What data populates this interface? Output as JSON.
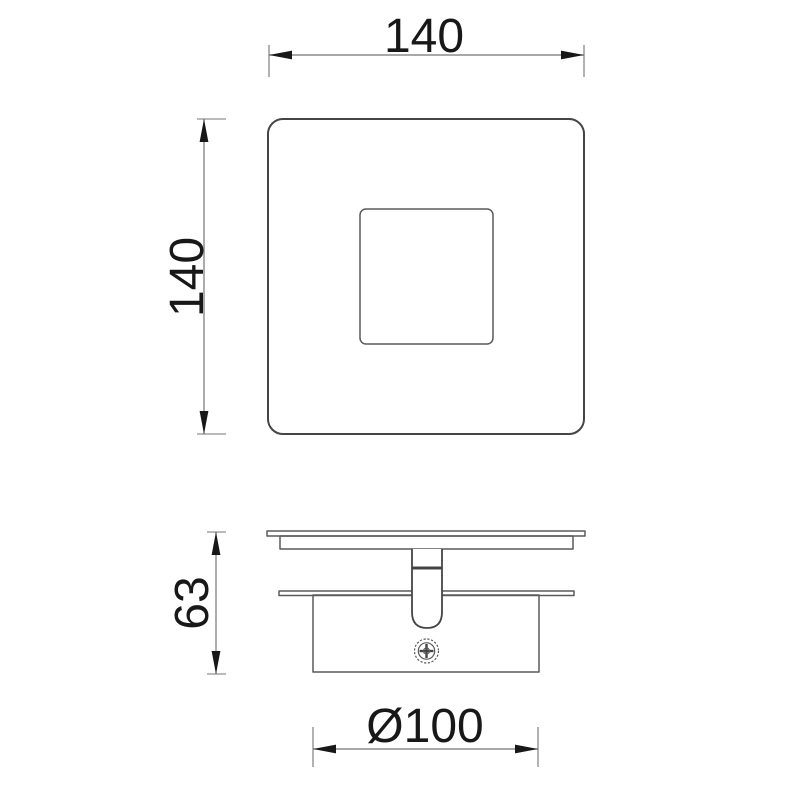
{
  "colors": {
    "background": "#ffffff",
    "object_line": "#454545",
    "object_line_light": "#5a5a5a",
    "dimension_line": "#747474",
    "text_color": "#181818"
  },
  "dimensions": {
    "width": {
      "label": "140"
    },
    "height": {
      "label": "140"
    },
    "depth": {
      "label": "63"
    },
    "diameter": {
      "label": "Ø100"
    }
  }
}
